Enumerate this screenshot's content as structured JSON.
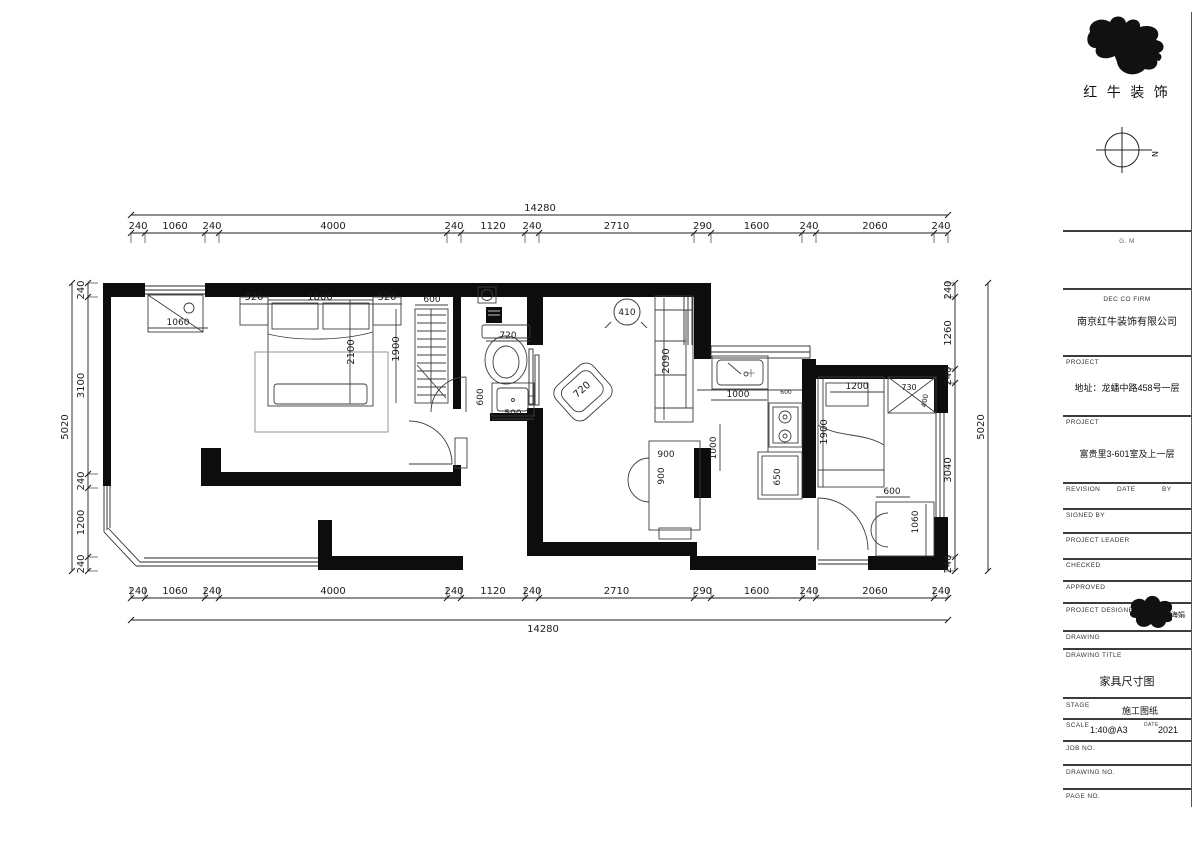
{
  "header": {
    "logo_text": "红 牛 装 饰",
    "compass_n": "N",
    "note": "G. M"
  },
  "dims": {
    "top_total": "14280",
    "bottom_total": "14280",
    "left_total": "5020",
    "right_total": "5020",
    "top_segments": [
      "240",
      "1060",
      "240",
      "4000",
      "240",
      "1120",
      "240",
      "2710",
      "290",
      "1600",
      "240",
      "2060",
      "240"
    ],
    "bottom_segments": [
      "240",
      "1060",
      "240",
      "4000",
      "240",
      "1120",
      "240",
      "2710",
      "290",
      "1600",
      "240",
      "2060",
      "240"
    ],
    "left_segments": [
      "240",
      "3100",
      "240",
      "1200",
      "240"
    ],
    "right_segments": [
      "240",
      "1260",
      "240",
      "3040",
      "240"
    ]
  },
  "plan_labels": [
    {
      "t": "520",
      "x": 254,
      "y": 300
    },
    {
      "t": "1800",
      "x": 320,
      "y": 300
    },
    {
      "t": "520",
      "x": 387,
      "y": 300
    },
    {
      "t": "600",
      "x": 432,
      "y": 302,
      "s": 9
    },
    {
      "t": "1060",
      "x": 178,
      "y": 325,
      "s": 9
    },
    {
      "t": "2100",
      "x": 354,
      "y": 352,
      "r": -90
    },
    {
      "t": "1900",
      "x": 399,
      "y": 349,
      "r": -90
    },
    {
      "t": "720",
      "x": 508,
      "y": 338,
      "s": 9
    },
    {
      "t": "600",
      "x": 483,
      "y": 397,
      "r": -90,
      "s": 9
    },
    {
      "t": "500",
      "x": 513,
      "y": 416,
      "s": 9
    },
    {
      "t": "410",
      "x": 627,
      "y": 315,
      "s": 9,
      "c": true
    },
    {
      "t": "2090",
      "x": 669,
      "y": 361,
      "r": -90
    },
    {
      "t": "720",
      "x": 584,
      "y": 392,
      "r": -42
    },
    {
      "t": "900",
      "x": 666,
      "y": 457,
      "s": 9
    },
    {
      "t": "900",
      "x": 664,
      "y": 476,
      "r": -90,
      "s": 9
    },
    {
      "t": "1000",
      "x": 716,
      "y": 448,
      "r": -90,
      "s": 9
    },
    {
      "t": "1000",
      "x": 738,
      "y": 397,
      "s": 9
    },
    {
      "t": "600",
      "x": 786,
      "y": 394,
      "s": 6
    },
    {
      "t": "650",
      "x": 780,
      "y": 477,
      "r": -90,
      "s": 9
    },
    {
      "t": "1200",
      "x": 857,
      "y": 389,
      "s": 9
    },
    {
      "t": "1900",
      "x": 827,
      "y": 432,
      "r": -90
    },
    {
      "t": "730",
      "x": 909,
      "y": 390,
      "s": 8
    },
    {
      "t": "400",
      "x": 927,
      "y": 401,
      "r": -80,
      "s": 7
    },
    {
      "t": "600",
      "x": 892,
      "y": 494,
      "s": 9
    },
    {
      "t": "1060",
      "x": 918,
      "y": 522,
      "r": -90,
      "s": 9
    }
  ],
  "titleblock": {
    "note": "G. M",
    "firm_label": "DEC CO FIRM",
    "firm": "南京红牛装饰有限公司",
    "project_label": "PROJECT",
    "project_addr": "地址：龙蟠中路458号一层",
    "project_label2": "PROJECT",
    "project_name": "富贵里3-601室及上一层",
    "revision": "REVISION",
    "date": "DATE",
    "by": "BY",
    "signed_by": "SIGNED BY",
    "project_leader": "PROJECT LEADER",
    "checked": "CHECKED",
    "approved": "APPROVED",
    "project_designer": "PROJECT DESIGNER",
    "designer_name": "朱海娟",
    "drawing": "DRAWING",
    "drawing_title_label": "DRAWING TITLE",
    "drawing_title": "家具尺寸图",
    "stage_label": "STAGE",
    "stage": "施工图纸",
    "scale_label": "SCALE",
    "scale": "1:40@A3",
    "date_label": "DATE",
    "date_value": "2021",
    "job_no": "JOB NO.",
    "drawing_no": "DRAWING NO.",
    "page_no": "PAGE NO."
  }
}
